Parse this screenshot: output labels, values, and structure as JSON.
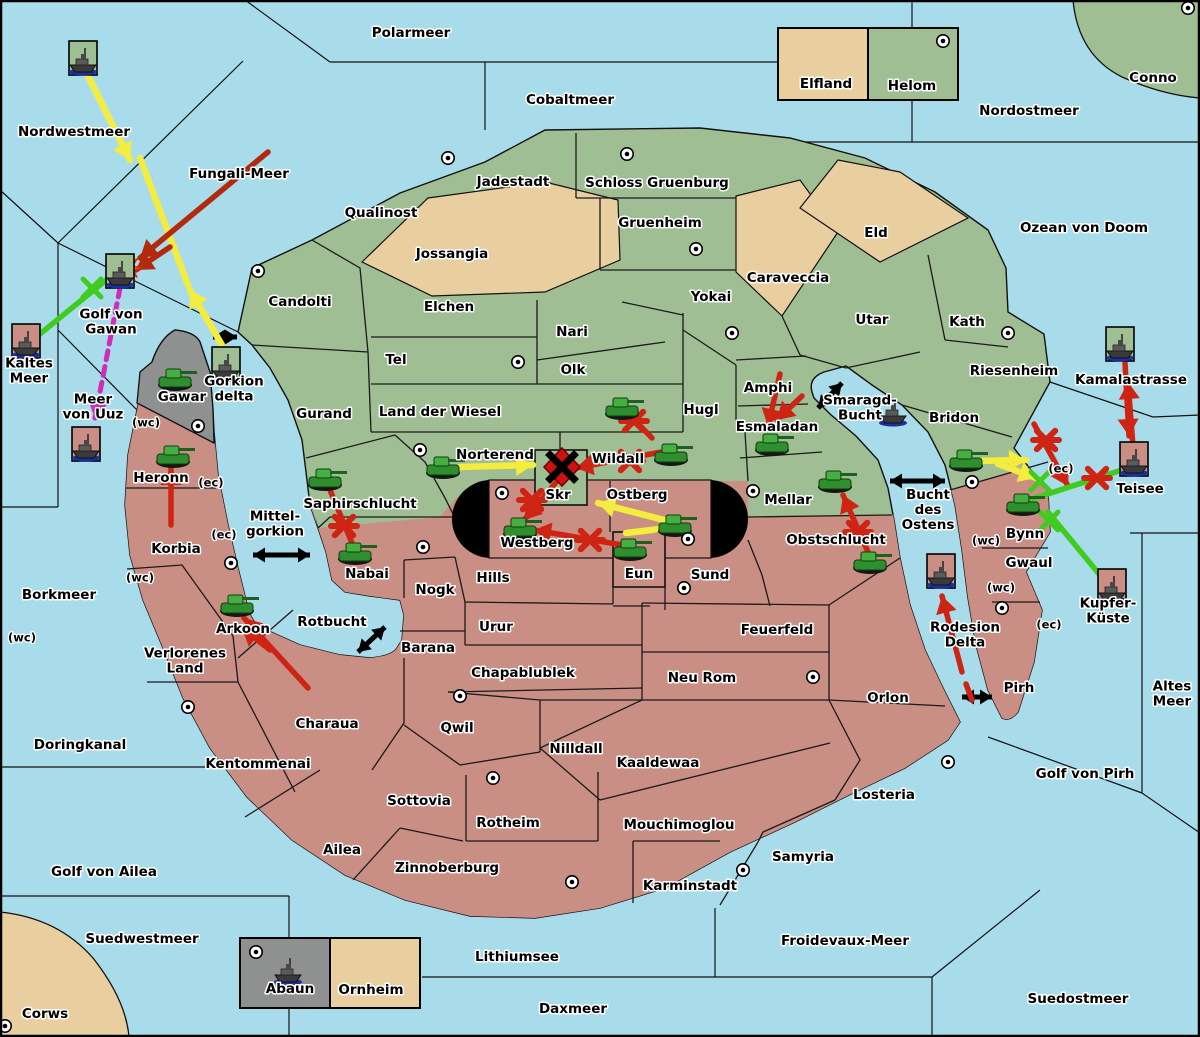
{
  "map": {
    "colors": {
      "sea": "#A9DCEA",
      "land_green": "#9FBE93",
      "land_red": "#C98E84",
      "land_tan": "#E9CEA0",
      "land_gray": "#8F9191",
      "border": "#101010",
      "arrow_yellow": "#F4EC3E",
      "arrow_red": "#CE2414",
      "arrow_darkred": "#B2290E",
      "arrow_green": "#3FCC1F",
      "arrow_magenta": "#D02CB8",
      "burst_orange": "#FF9000"
    },
    "seas": [
      {
        "name": "Polarmeer",
        "x": 411,
        "y": 33
      },
      {
        "name": "Cobaltmeer",
        "x": 570,
        "y": 100
      },
      {
        "name": "Nordostmeer",
        "x": 1029,
        "y": 111
      },
      {
        "name": "Ozean von Doom",
        "x": 1084,
        "y": 228
      },
      {
        "name": "Nordwestmeer",
        "x": 74,
        "y": 132
      },
      {
        "name": "Fungali-Meer",
        "x": 239,
        "y": 174
      },
      {
        "name": "Golf von|Gawan",
        "x": 111,
        "y": 322
      },
      {
        "name": "Kaltes|Meer",
        "x": 29,
        "y": 371
      },
      {
        "name": "Meer|von Uuz",
        "x": 93,
        "y": 407
      },
      {
        "name": "Borkmeer",
        "x": 59,
        "y": 595
      },
      {
        "name": "Doringkanal",
        "x": 80,
        "y": 745
      },
      {
        "name": "Golf von Ailea",
        "x": 104,
        "y": 872
      },
      {
        "name": "Suedwestmeer",
        "x": 142,
        "y": 939
      },
      {
        "name": "Lithiumsee",
        "x": 517,
        "y": 957
      },
      {
        "name": "Daxmeer",
        "x": 573,
        "y": 1009
      },
      {
        "name": "Froidevaux-Meer",
        "x": 845,
        "y": 941
      },
      {
        "name": "Suedostmeer",
        "x": 1078,
        "y": 999
      },
      {
        "name": "Golf von Pirh",
        "x": 1085,
        "y": 774
      },
      {
        "name": "Altes|Meer",
        "x": 1172,
        "y": 694
      },
      {
        "name": "Smaragd-|Bucht",
        "x": 860,
        "y": 408
      },
      {
        "name": "Bucht|des|Ostens",
        "x": 928,
        "y": 510
      },
      {
        "name": "Mittel-|gorkion",
        "x": 275,
        "y": 524
      },
      {
        "name": "Rotbucht",
        "x": 332,
        "y": 622
      },
      {
        "name": "Gorkion|delta",
        "x": 234,
        "y": 389
      },
      {
        "name": "Rodesion|Delta",
        "x": 965,
        "y": 635
      },
      {
        "name": "Kamalastrasse",
        "x": 1131,
        "y": 380
      },
      {
        "name": "Teisee",
        "x": 1140,
        "y": 489
      },
      {
        "name": "Kupfer-|Küste",
        "x": 1108,
        "y": 611
      }
    ],
    "territories": [
      {
        "name": "Jadestadt",
        "x": 513,
        "y": 182
      },
      {
        "name": "Schloss Gruenburg",
        "x": 657,
        "y": 183
      },
      {
        "name": "Qualinost",
        "x": 381,
        "y": 213
      },
      {
        "name": "Jossangia",
        "x": 452,
        "y": 254
      },
      {
        "name": "Gruenheim",
        "x": 660,
        "y": 223
      },
      {
        "name": "Caraveccia",
        "x": 788,
        "y": 278
      },
      {
        "name": "Eld",
        "x": 876,
        "y": 233
      },
      {
        "name": "Yokai",
        "x": 711,
        "y": 297
      },
      {
        "name": "Candolti",
        "x": 300,
        "y": 302
      },
      {
        "name": "Elchen",
        "x": 449,
        "y": 307
      },
      {
        "name": "Nari",
        "x": 572,
        "y": 332
      },
      {
        "name": "Tel",
        "x": 396,
        "y": 360
      },
      {
        "name": "Olk",
        "x": 573,
        "y": 370
      },
      {
        "name": "Utar",
        "x": 872,
        "y": 320
      },
      {
        "name": "Kath",
        "x": 967,
        "y": 322
      },
      {
        "name": "Amphi",
        "x": 768,
        "y": 388
      },
      {
        "name": "Esmaladan",
        "x": 777,
        "y": 427
      },
      {
        "name": "Riesenheim",
        "x": 1014,
        "y": 371
      },
      {
        "name": "Bridon",
        "x": 954,
        "y": 418
      },
      {
        "name": "Gurand",
        "x": 324,
        "y": 414
      },
      {
        "name": "Land der Wiesel",
        "x": 440,
        "y": 412
      },
      {
        "name": "Hugl",
        "x": 701,
        "y": 410
      },
      {
        "name": "Norterend",
        "x": 495,
        "y": 455
      },
      {
        "name": "Wildall",
        "x": 618,
        "y": 459
      },
      {
        "name": "Skr",
        "x": 558,
        "y": 495
      },
      {
        "name": "Ostberg",
        "x": 637,
        "y": 495
      },
      {
        "name": "Mellar",
        "x": 788,
        "y": 500
      },
      {
        "name": "Saphirschlucht",
        "x": 360,
        "y": 504
      },
      {
        "name": "Westberg",
        "x": 537,
        "y": 543
      },
      {
        "name": "Eun",
        "x": 639,
        "y": 574
      },
      {
        "name": "Sund",
        "x": 710,
        "y": 575
      },
      {
        "name": "Obstschlucht",
        "x": 836,
        "y": 540
      },
      {
        "name": "Bynn",
        "x": 1025,
        "y": 534
      },
      {
        "name": "Gwaul",
        "x": 1029,
        "y": 563
      },
      {
        "name": "Heronn",
        "x": 161,
        "y": 478
      },
      {
        "name": "Korbia",
        "x": 176,
        "y": 549
      },
      {
        "name": "Nabai",
        "x": 367,
        "y": 574
      },
      {
        "name": "Nogk",
        "x": 435,
        "y": 590
      },
      {
        "name": "Hills",
        "x": 493,
        "y": 578
      },
      {
        "name": "Urur",
        "x": 496,
        "y": 627
      },
      {
        "name": "Feuerfeld",
        "x": 777,
        "y": 630
      },
      {
        "name": "Barana",
        "x": 428,
        "y": 648
      },
      {
        "name": "Chapablublek",
        "x": 523,
        "y": 673
      },
      {
        "name": "Neu Rom",
        "x": 702,
        "y": 678
      },
      {
        "name": "Arkoon",
        "x": 243,
        "y": 629
      },
      {
        "name": "Verlorenes|Land",
        "x": 185,
        "y": 661
      },
      {
        "name": "Charaua",
        "x": 327,
        "y": 724
      },
      {
        "name": "Qwil",
        "x": 457,
        "y": 728
      },
      {
        "name": "Nilldall",
        "x": 576,
        "y": 749
      },
      {
        "name": "Kaaldewaa",
        "x": 658,
        "y": 763
      },
      {
        "name": "Orlon",
        "x": 888,
        "y": 698
      },
      {
        "name": "Pirh",
        "x": 1019,
        "y": 688
      },
      {
        "name": "Kentommenai",
        "x": 258,
        "y": 764
      },
      {
        "name": "Sottovia",
        "x": 419,
        "y": 801
      },
      {
        "name": "Rotheim",
        "x": 508,
        "y": 823
      },
      {
        "name": "Mouchimoglou",
        "x": 679,
        "y": 825
      },
      {
        "name": "Losteria",
        "x": 884,
        "y": 795
      },
      {
        "name": "Ailea",
        "x": 342,
        "y": 850
      },
      {
        "name": "Zinnoberburg",
        "x": 447,
        "y": 868
      },
      {
        "name": "Samyria",
        "x": 803,
        "y": 857
      },
      {
        "name": "Karminstadt",
        "x": 690,
        "y": 886
      },
      {
        "name": "Gawar",
        "x": 182,
        "y": 397
      },
      {
        "name": "Conno",
        "x": 1153,
        "y": 78
      },
      {
        "name": "Corws",
        "x": 45,
        "y": 1014
      },
      {
        "name": "Elfland",
        "x": 826,
        "y": 84
      },
      {
        "name": "Helom",
        "x": 912,
        "y": 86
      },
      {
        "name": "Abaun",
        "x": 290,
        "y": 989
      },
      {
        "name": "Ornheim",
        "x": 371,
        "y": 990
      }
    ],
    "coast_tags": [
      {
        "text": "(wc)",
        "x": 146,
        "y": 423
      },
      {
        "text": "(ec)",
        "x": 211,
        "y": 483
      },
      {
        "text": "(ec)",
        "x": 224,
        "y": 535
      },
      {
        "text": "(wc)",
        "x": 140,
        "y": 578
      },
      {
        "text": "(wc)",
        "x": 22,
        "y": 638
      },
      {
        "text": "(ec)",
        "x": 1061,
        "y": 469
      },
      {
        "text": "(wc)",
        "x": 986,
        "y": 541
      },
      {
        "text": "(wc)",
        "x": 1001,
        "y": 588
      },
      {
        "text": "(ec)",
        "x": 1049,
        "y": 625
      }
    ],
    "supply_dots": [
      [
        448,
        158
      ],
      [
        627,
        154
      ],
      [
        943,
        41
      ],
      [
        1188,
        8
      ],
      [
        258,
        271
      ],
      [
        696,
        249
      ],
      [
        732,
        333
      ],
      [
        518,
        362
      ],
      [
        1008,
        333
      ],
      [
        198,
        426
      ],
      [
        420,
        450
      ],
      [
        502,
        493
      ],
      [
        688,
        539
      ],
      [
        684,
        588
      ],
      [
        753,
        491
      ],
      [
        972,
        482
      ],
      [
        231,
        563
      ],
      [
        188,
        707
      ],
      [
        423,
        547
      ],
      [
        460,
        696
      ],
      [
        493,
        778
      ],
      [
        813,
        677
      ],
      [
        948,
        762
      ],
      [
        572,
        882
      ],
      [
        743,
        870
      ],
      [
        1002,
        608
      ],
      [
        256,
        952
      ],
      [
        5,
        1026
      ]
    ],
    "units": {
      "tanks": [
        [
          175,
          378
        ],
        [
          173,
          455
        ],
        [
          325,
          478
        ],
        [
          355,
          552
        ],
        [
          237,
          604
        ],
        [
          443,
          466
        ],
        [
          622,
          407
        ],
        [
          671,
          453
        ],
        [
          520,
          527
        ],
        [
          630,
          548
        ],
        [
          675,
          524
        ],
        [
          772,
          443
        ],
        [
          835,
          480
        ],
        [
          870,
          561
        ],
        [
          966,
          459
        ],
        [
          1023,
          503
        ]
      ],
      "ships_boxed": [
        {
          "x": 83,
          "y": 58,
          "box": "green"
        },
        {
          "x": 120,
          "y": 271,
          "box": "green"
        },
        {
          "x": 26,
          "y": 341,
          "box": "red"
        },
        {
          "x": 86,
          "y": 444,
          "box": "red"
        },
        {
          "x": 226,
          "y": 364,
          "box": "green"
        },
        {
          "x": 941,
          "y": 571,
          "box": "red"
        },
        {
          "x": 1120,
          "y": 344,
          "box": "green"
        },
        {
          "x": 1134,
          "y": 459,
          "box": "red"
        },
        {
          "x": 1112,
          "y": 586,
          "box": "red"
        }
      ],
      "ships": [
        [
          893,
          413
        ],
        [
          288,
          972
        ]
      ]
    },
    "straits": [
      {
        "x1": 213,
        "y1": 337,
        "x2": 237,
        "y2": 337
      },
      {
        "x1": 253,
        "y1": 555,
        "x2": 310,
        "y2": 555
      },
      {
        "x1": 818,
        "y1": 408,
        "x2": 842,
        "y2": 383
      },
      {
        "x1": 890,
        "y1": 481,
        "x2": 945,
        "y2": 481
      },
      {
        "x1": 358,
        "y1": 652,
        "x2": 385,
        "y2": 627
      },
      {
        "x1": 962,
        "y1": 697,
        "x2": 992,
        "y2": 697
      }
    ],
    "moves": {
      "yellow": [
        {
          "pts": [
            [
              86,
              72
            ],
            [
              130,
              160
            ]
          ],
          "head": true
        },
        {
          "pts": [
            [
              222,
              345
            ],
            [
              190,
              290
            ]
          ],
          "head": true
        },
        {
          "pts": [
            [
              188,
              285
            ],
            [
              140,
              158
            ]
          ],
          "head": false
        },
        {
          "pts": [
            [
              460,
              467
            ],
            [
              533,
              465
            ]
          ],
          "head": true
        },
        {
          "pts": [
            [
              672,
              522
            ],
            [
              598,
              503
            ]
          ],
          "head": true
        },
        {
          "pts": [
            [
              668,
              528
            ],
            [
              626,
              533
            ]
          ],
          "head": false
        },
        {
          "pts": [
            [
              975,
              461
            ],
            [
              1026,
              460
            ]
          ],
          "head": true
        },
        {
          "pts": [
            [
              998,
              464
            ],
            [
              1036,
              478
            ]
          ],
          "head": true
        }
      ],
      "red": [
        {
          "pts": [
            [
              268,
              152
            ],
            [
              140,
              258
            ]
          ],
          "head": true,
          "dark": true
        },
        {
          "pts": [
            [
              170,
              247
            ],
            [
              136,
              270
            ]
          ],
          "head": true,
          "dark": true
        },
        {
          "pts": [
            [
              171,
              525
            ],
            [
              171,
              468
            ]
          ],
          "head": true
        },
        {
          "pts": [
            [
              308,
              688
            ],
            [
              244,
              618
            ]
          ],
          "head": true
        },
        {
          "pts": [
            [
              270,
              650
            ],
            [
              242,
              628
            ]
          ],
          "head": true
        },
        {
          "pts": [
            [
              622,
              407
            ],
            [
              652,
              438
            ]
          ],
          "head": false
        },
        {
          "pts": [
            [
              672,
              450
            ],
            [
              576,
              468
            ]
          ],
          "head": true
        },
        {
          "pts": [
            [
              558,
              480
            ],
            [
              524,
              520
            ]
          ],
          "head": true
        },
        {
          "pts": [
            [
              628,
              546
            ],
            [
              534,
              530
            ]
          ],
          "head": true
        },
        {
          "pts": [
            [
              330,
              490
            ],
            [
              352,
              543
            ]
          ],
          "head": false
        },
        {
          "pts": [
            [
              780,
              374
            ],
            [
              768,
              426
            ]
          ],
          "head": true
        },
        {
          "pts": [
            [
              802,
              396
            ],
            [
              777,
              420
            ]
          ],
          "head": true
        },
        {
          "pts": [
            [
              868,
              552
            ],
            [
              843,
              495
            ]
          ],
          "head": true
        },
        {
          "pts": [
            [
              1034,
              424
            ],
            [
              1068,
              486
            ]
          ],
          "head": true
        },
        {
          "pts": [
            [
              1125,
              363
            ],
            [
              1129,
              436
            ]
          ],
          "head": true
        },
        {
          "pts": [
            [
              1133,
              446
            ],
            [
              1128,
              382
            ]
          ],
          "head": true
        },
        {
          "pts": [
            [
              962,
              672
            ],
            [
              942,
              596
            ]
          ],
          "head": true
        },
        {
          "pts": [
            [
              972,
              700
            ],
            [
              966,
              684
            ]
          ],
          "head": false
        }
      ],
      "green": [
        {
          "pts": [
            [
              35,
              338
            ],
            [
              116,
              272
            ]
          ],
          "head": false
        },
        {
          "pts": [
            [
              1125,
              469
            ],
            [
              1026,
              501
            ]
          ],
          "head": false
        },
        {
          "pts": [
            [
              1048,
              512
            ],
            [
              1104,
              580
            ]
          ],
          "head": false
        }
      ],
      "magenta": [
        {
          "pts": [
            [
              120,
              288
            ],
            [
              95,
              418
            ]
          ],
          "head": true,
          "dash": true
        }
      ]
    },
    "battle_marks": {
      "red_asterisk": [
        [
          634,
          421
        ],
        [
          630,
          461
        ],
        [
          532,
          500
        ],
        [
          590,
          540
        ],
        [
          344,
          526
        ],
        [
          858,
          532
        ],
        [
          1046,
          440
        ],
        [
          1097,
          478
        ]
      ],
      "green_x": [
        [
          92,
          288
        ],
        [
          1040,
          481
        ],
        [
          1049,
          521
        ]
      ],
      "burst": [
        [
          128,
          268
        ]
      ],
      "clash": [
        [
          562,
          467
        ]
      ]
    }
  }
}
